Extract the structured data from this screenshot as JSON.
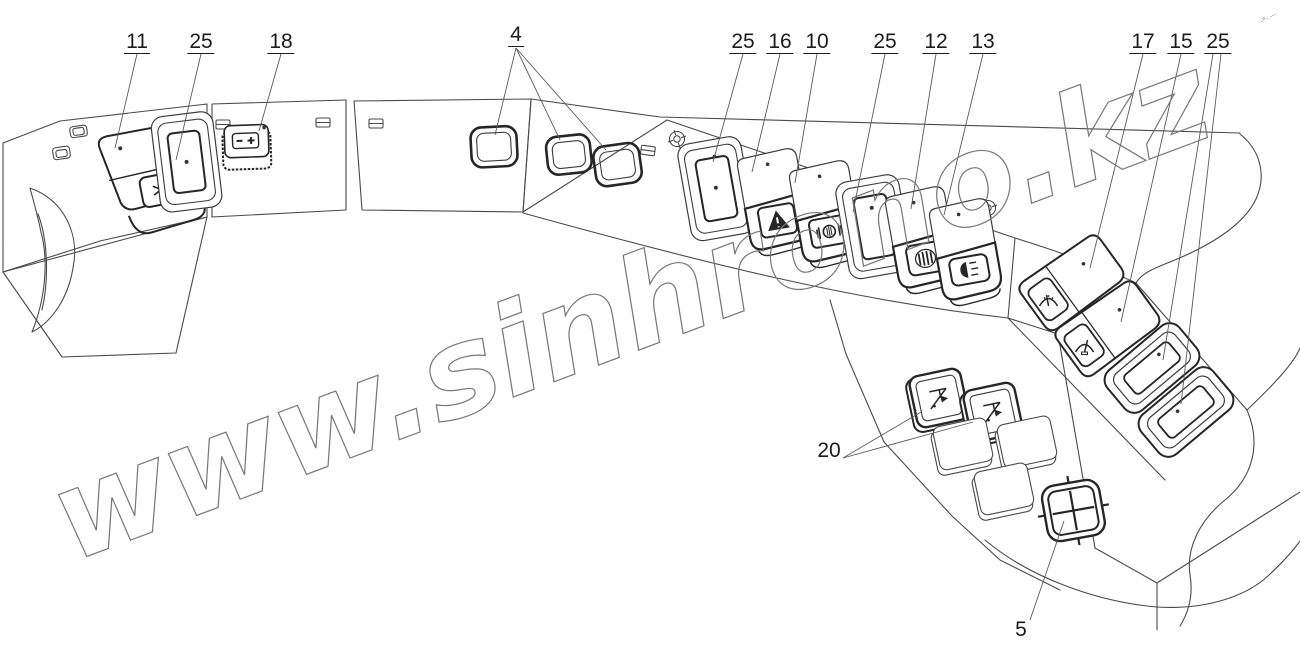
{
  "diagram": {
    "watermark": "www.sinhrono.kz",
    "corner_marks": "·°· ···"
  },
  "callouts": [
    {
      "number": "11",
      "target": "air-conditioner-switch"
    },
    {
      "number": "25",
      "target": "rocker-switch-left"
    },
    {
      "number": "18",
      "target": "battery-disconnect-button"
    },
    {
      "number": "4",
      "target": "blanking-plugs"
    },
    {
      "number": "25",
      "target": "rocker-switch-mid-1"
    },
    {
      "number": "16",
      "target": "hazard-warning-switch"
    },
    {
      "number": "10",
      "target": "work-light-switch"
    },
    {
      "number": "25",
      "target": "rocker-switch-mid-2"
    },
    {
      "number": "12",
      "target": "heater-fan-switch"
    },
    {
      "number": "13",
      "target": "headlight-switch"
    },
    {
      "number": "17",
      "target": "wiper-washer-switch"
    },
    {
      "number": "15",
      "target": "rear-wiper-switch"
    },
    {
      "number": "25",
      "target": "rocker-switches-right"
    },
    {
      "number": "20",
      "target": "hitch-control-buttons"
    },
    {
      "number": "5",
      "target": "four-way-switch"
    }
  ],
  "icons": {
    "snowflake-icon": "air conditioner snowflake",
    "battery-icon": "battery minus-plus",
    "hazard-icon": "warning triangle",
    "worklight-icon": "work lamp",
    "heater-icon": "heater grille",
    "headlight-icon": "headlamp with beams",
    "wiper-icon": "wiper with washer",
    "hitch-icon": "implement hitch",
    "cross-icon": "four-way cross",
    "screw-icon": "crosshead screw"
  }
}
